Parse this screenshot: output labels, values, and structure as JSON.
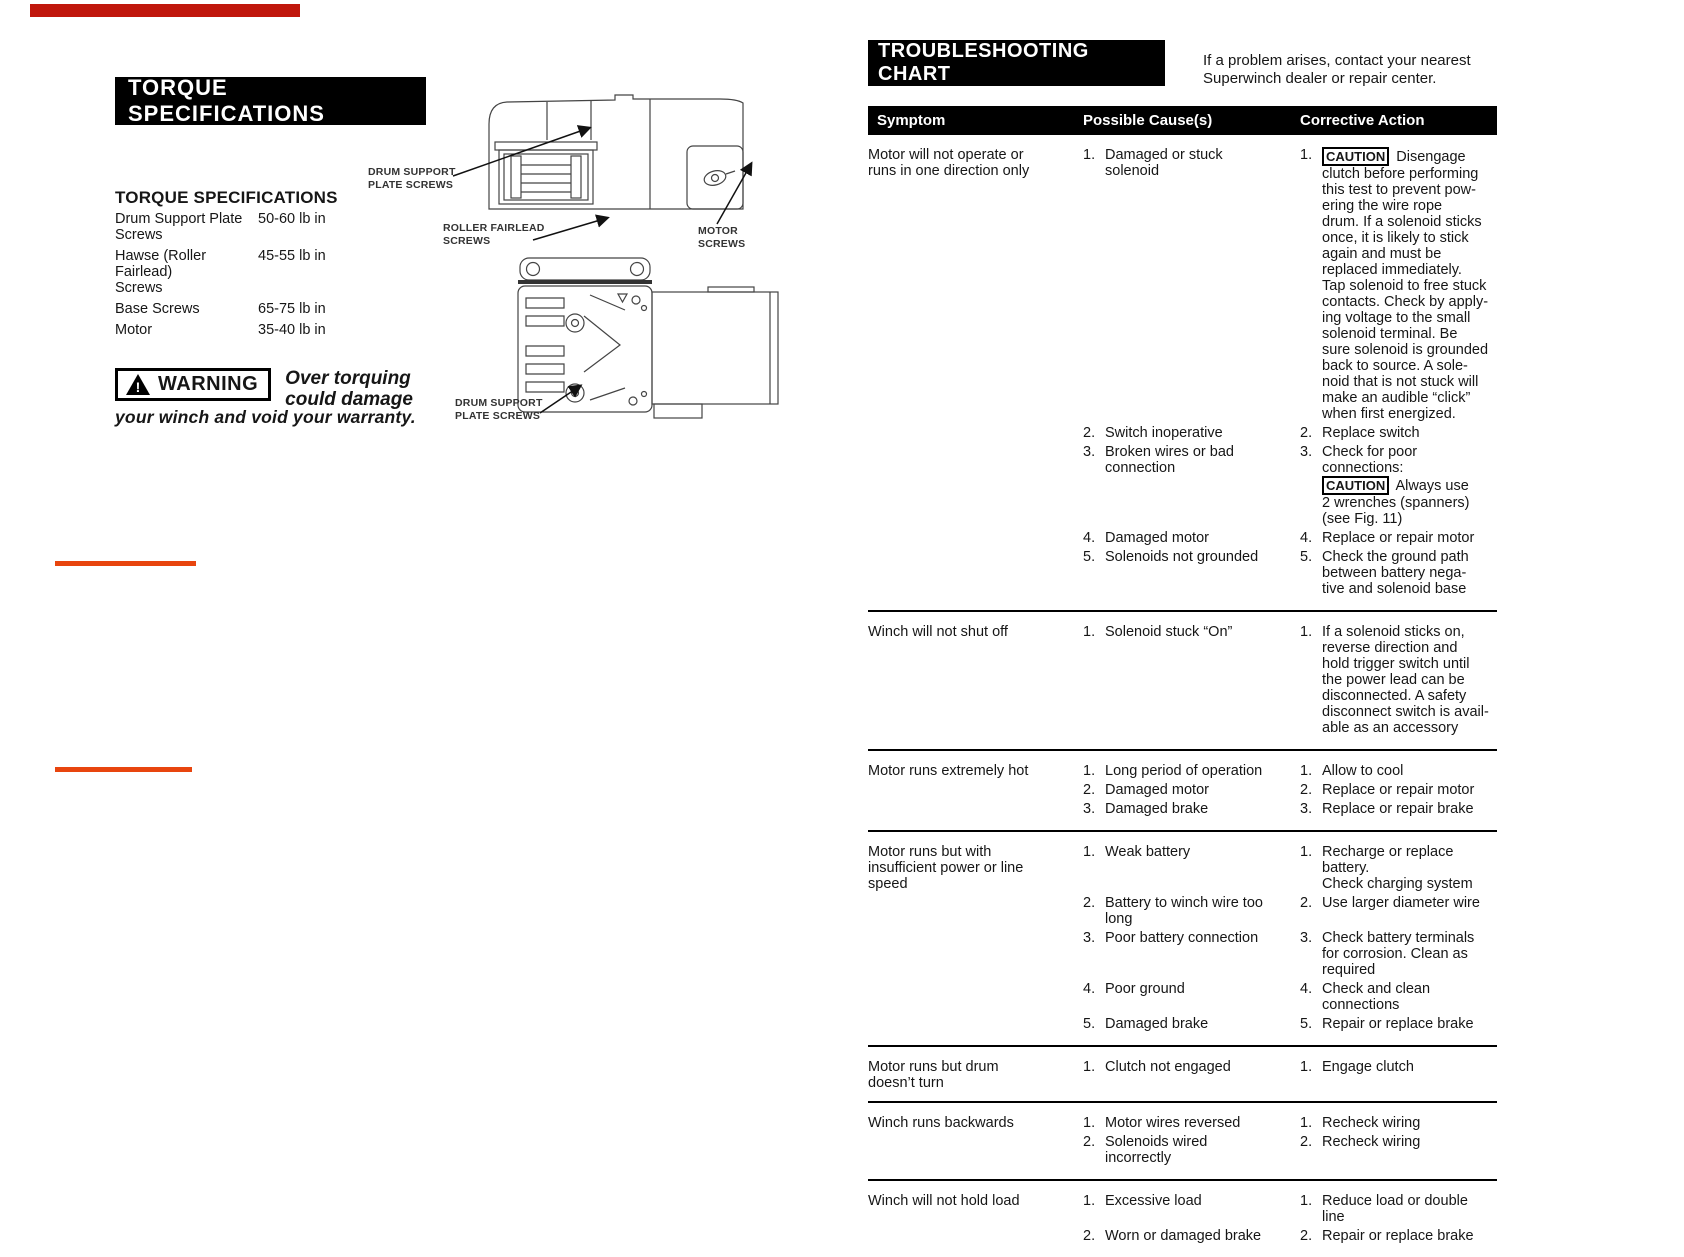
{
  "decor": {
    "top_bar_color": "#c0170c",
    "rule_color": "#e8450e"
  },
  "torque": {
    "banner": "TORQUE SPECIFICATIONS",
    "heading": "TORQUE SPECIFICATIONS",
    "specs": [
      {
        "item": "Drum Support Plate\nScrews",
        "value": "50-60 lb in"
      },
      {
        "item": "Hawse (Roller Fairlead)\nScrews",
        "value": "45-55 lb in"
      },
      {
        "item": "Base Screws",
        "value": "65-75 lb in"
      },
      {
        "item": "Motor",
        "value": "35-40 lb in"
      }
    ],
    "warning_label": "WARNING",
    "warning_emph": "Over torquing\ncould damage",
    "warning_tail": "your winch and void your warranty."
  },
  "diagram": {
    "labels": {
      "drum_support_top": "DRUM SUPPORT\nPLATE SCREWS",
      "roller_fairlead": "ROLLER FAIRLEAD\nSCREWS",
      "motor": "MOTOR\nSCREWS",
      "drum_support_bottom": "DRUM SUPPORT\nPLATE SCREWS"
    }
  },
  "troubleshooting": {
    "banner": "TROUBLESHOOTING CHART",
    "note": "If a problem arises, contact your nearest\nSuperwinch dealer or repair center.",
    "caution_label": "CAUTION",
    "headers": [
      "Symptom",
      "Possible Cause(s)",
      "Corrective Action"
    ],
    "rows": [
      {
        "symptom": "Motor will not operate or\nruns in one direction only",
        "items": [
          {
            "cause": "Damaged or stuck\nsolenoid",
            "action": "[[CAUTION]] Disengage\nclutch before performing\nthis test to prevent pow-\nering the wire rope\ndrum. If a solenoid sticks\nonce, it is likely to stick\nagain and must be\nreplaced immediately.\nTap solenoid to free stuck\ncontacts. Check by apply-\ning voltage to the small\nsolenoid terminal. Be\nsure solenoid is grounded\nback to source. A sole-\nnoid that is not stuck will\nmake an audible “click”\nwhen first energized."
          },
          {
            "cause": "Switch inoperative",
            "action": "Replace switch"
          },
          {
            "cause": "Broken wires or bad\nconnection",
            "action": "Check for poor connections:\n[[CAUTION]] Always use\n2 wrenches (spanners)\n(see Fig. 11)"
          },
          {
            "cause": "Damaged motor",
            "action": "Replace or repair motor"
          },
          {
            "cause": "Solenoids not grounded",
            "action": "Check the ground path\nbetween battery nega-\ntive and solenoid base"
          }
        ]
      },
      {
        "symptom": "Winch will not shut off",
        "items": [
          {
            "cause": "Solenoid stuck “On”",
            "action": "If a solenoid sticks on,\nreverse direction and\nhold trigger switch until\nthe power lead can be\ndisconnected. A safety\ndisconnect switch is avail-\nable as an accessory"
          }
        ]
      },
      {
        "symptom": "Motor runs extremely hot",
        "items": [
          {
            "cause": "Long period of operation",
            "action": "Allow to cool"
          },
          {
            "cause": "Damaged motor",
            "action": "Replace or repair motor"
          },
          {
            "cause": "Damaged brake",
            "action": "Replace or repair brake"
          }
        ]
      },
      {
        "symptom": "Motor runs but with\ninsufficient power or line\nspeed",
        "items": [
          {
            "cause": "Weak battery",
            "action": "Recharge or replace battery.\nCheck charging system"
          },
          {
            "cause": "Battery to winch wire too\nlong",
            "action": "Use larger diameter wire"
          },
          {
            "cause": "Poor battery connection",
            "action": "Check battery terminals\nfor corrosion. Clean as\nrequired"
          },
          {
            "cause": "Poor ground",
            "action": "Check and clean\nconnections"
          },
          {
            "cause": "Damaged brake",
            "action": "Repair or replace brake"
          }
        ]
      },
      {
        "symptom": "Motor runs but drum\ndoesn’t turn",
        "items": [
          {
            "cause": "Clutch not engaged",
            "action": "Engage clutch"
          }
        ]
      },
      {
        "symptom": "Winch runs backwards",
        "items": [
          {
            "cause": "Motor wires reversed",
            "action": "Recheck wiring"
          },
          {
            "cause": "Solenoids wired\nincorrectly",
            "action": "Recheck wiring"
          }
        ]
      },
      {
        "symptom": "Winch will not hold load",
        "items": [
          {
            "cause": "Excessive load",
            "action": "Reduce load or double\nline"
          },
          {
            "cause": "Worn or damaged brake",
            "action": "Repair or replace brake"
          }
        ]
      }
    ]
  }
}
